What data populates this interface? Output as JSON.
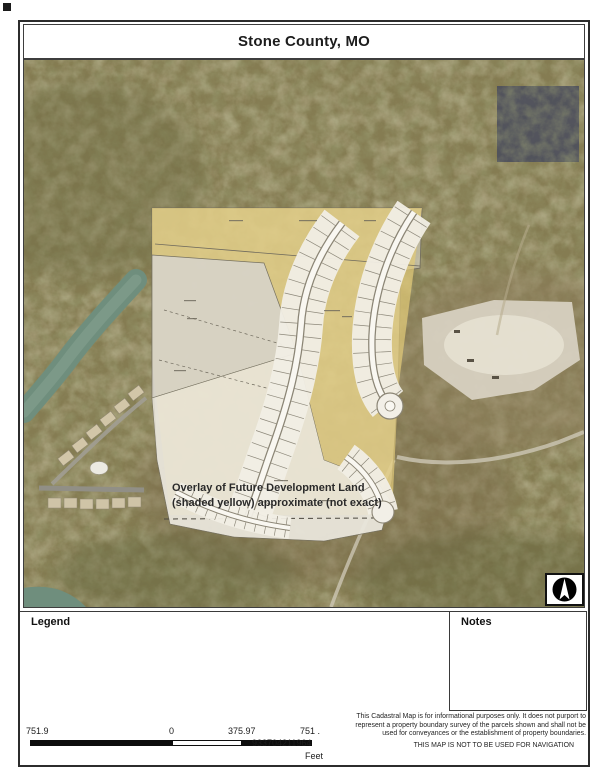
{
  "header": {
    "title": "Stone County, MO"
  },
  "map": {
    "annotation": {
      "line1": "Overlay of Future Development Land",
      "line2": "(shaded yellow)  approximate (not exact)"
    },
    "north_arrow_icon": "north-arrow"
  },
  "panels": {
    "legend_label": "Legend",
    "notes_label": "Notes"
  },
  "scale_bar": {
    "left_value": "751.9",
    "zero_value": "0",
    "mid_value": "375.97",
    "right_value_line1": "751 .",
    "right_value_line2": "933704211964",
    "unit": "Feet"
  },
  "disclaimer": {
    "line1": "This Cadastral Map is for informational purposes only.  It does not purport to",
    "line2": "represent a property boundary survey of the parcels shown and shall not be",
    "line3": "used for conveyances or the establishment of property boundaries.",
    "line4": "THIS MAP IS NOT TO BE USED FOR NAVIGATION"
  },
  "colors": {
    "aerial_base": "#857c52",
    "water": "#6f8e7d",
    "overlay_yellow": "#e2cb79",
    "plat_white": "#e9e6dc",
    "dark_patch": "#4d4f5c"
  }
}
